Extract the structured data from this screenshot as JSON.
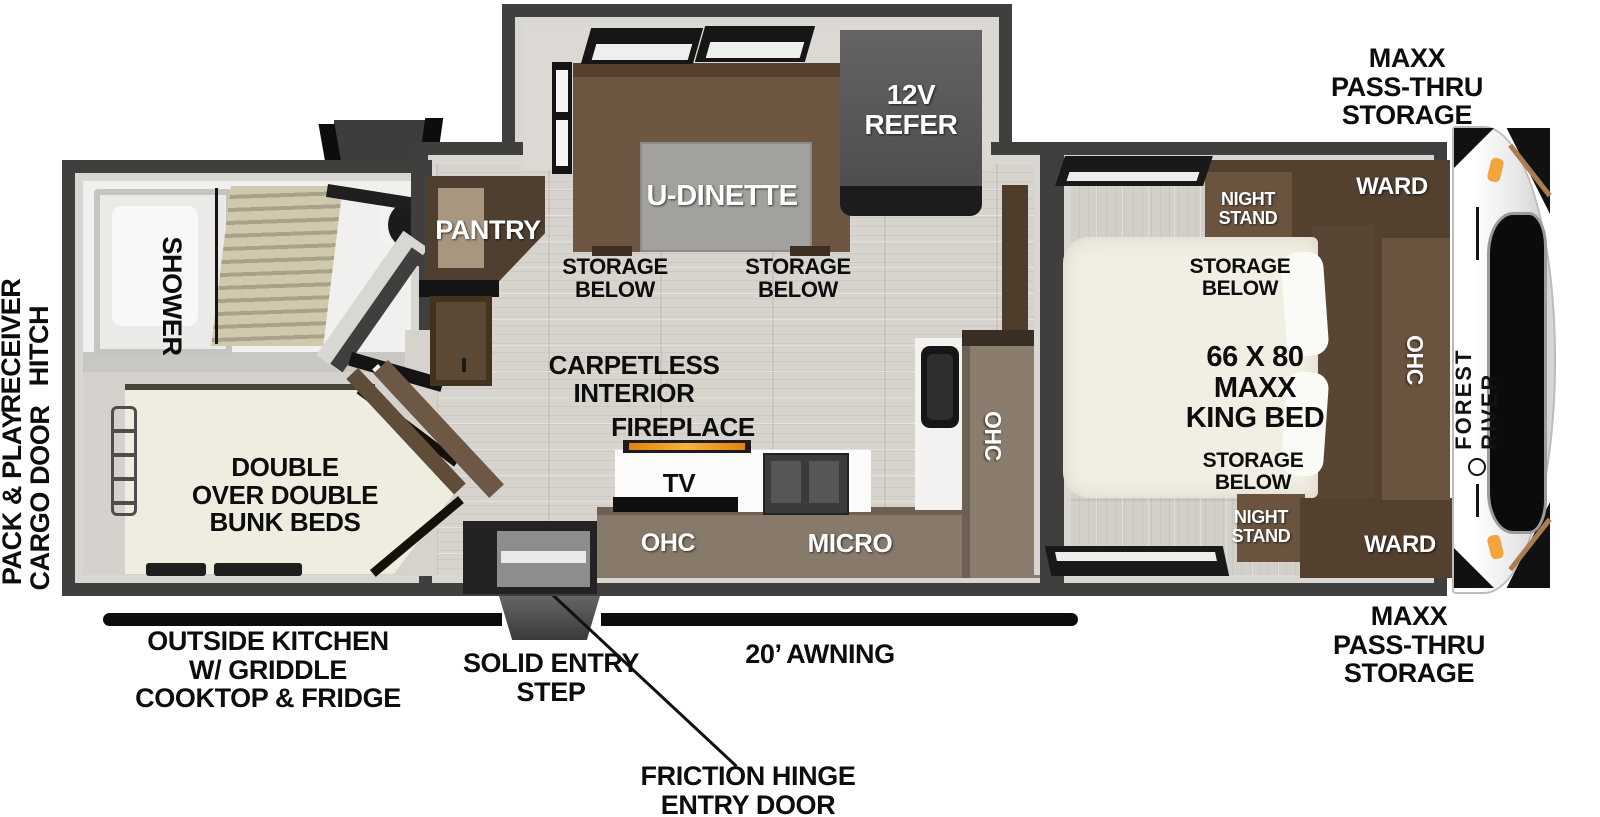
{
  "diagram_type": "rv-travel-trailer-floorplan",
  "brand": {
    "name": "FOREST RIVER"
  },
  "exterior": {
    "storage_front_top": "MAXX\nPASS-THRU\nSTORAGE",
    "storage_front_bottom": "MAXX\nPASS-THRU\nSTORAGE",
    "receiver_hitch": "RECEIVER\nHITCH",
    "cargo_door": "PACK & PLAY\nCARGO DOOR",
    "outside_kitchen": "OUTSIDE KITCHEN\nW/ GRIDDLE\nCOOKTOP & FRIDGE",
    "entry_step": "SOLID ENTRY\nSTEP",
    "awning": "20’ AWNING",
    "entry_door": "FRICTION HINGE\nENTRY DOOR"
  },
  "bedroom": {
    "ward_top": "WARD",
    "ward_bottom": "WARD",
    "night_stand_top": "NIGHT\nSTAND",
    "night_stand_bottom": "NIGHT\nSTAND",
    "storage_below_top": "STORAGE\nBELOW",
    "storage_below_bottom": "STORAGE\nBELOW",
    "bed": "66 X 80\nMAXX\nKING BED",
    "ohc": "OHC"
  },
  "kitchen": {
    "fireplace": "FIREPLACE",
    "tv": "TV",
    "ohc_base": "OHC",
    "micro": "MICRO",
    "ohc_side": "OHC"
  },
  "living": {
    "carpetless": "CARPETLESS\nINTERIOR",
    "dinette": "U-DINETTE",
    "storage_below_left": "STORAGE\nBELOW",
    "storage_below_right": "STORAGE\nBELOW",
    "refrigerator": "12V\nREFER",
    "pantry": "PANTRY"
  },
  "rear": {
    "shower": "SHOWER",
    "bunks": "DOUBLE\nOVER DOUBLE\nBUNK BEDS"
  },
  "colors": {
    "wall": "#403f3e",
    "furniture_brown": "#5d4936",
    "counter_brown": "#887a6a",
    "bed_cream": "#f1eee3",
    "accent_orange": "#f0a43e",
    "fireplace_orange": "#e78c12",
    "label_black": "#0d0d0d"
  }
}
